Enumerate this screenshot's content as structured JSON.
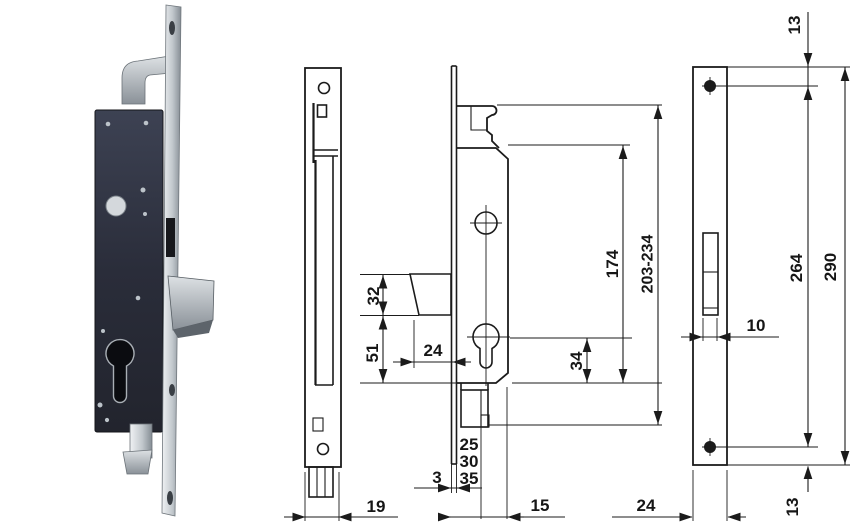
{
  "image_type": "technical catalog drawing of a hook-bolt mortise lock with strike plate",
  "colors": {
    "ink": "#1b1b1b",
    "paper": "#ffffff",
    "metal_light": "#eef0f2",
    "metal_dark": "#848c93",
    "lock_body_dark": "#262a35"
  },
  "drawing": {
    "side_view": {
      "plate_width": "19"
    },
    "front_view": {
      "hook_section": "32",
      "hook_to_center": "51",
      "hook_projection": "24",
      "center_to_bottom": "34",
      "case_height": "174",
      "overall_height": "203-234",
      "backset_options": [
        "25",
        "30",
        "35"
      ],
      "faceplate_thickness": "3",
      "case_depth": "15"
    },
    "strike_plate": {
      "top_hole_offset": "13",
      "hole_spacing": "264",
      "height": "290",
      "slot_width": "10",
      "width": "24",
      "bottom_hole_offset": "13"
    }
  }
}
